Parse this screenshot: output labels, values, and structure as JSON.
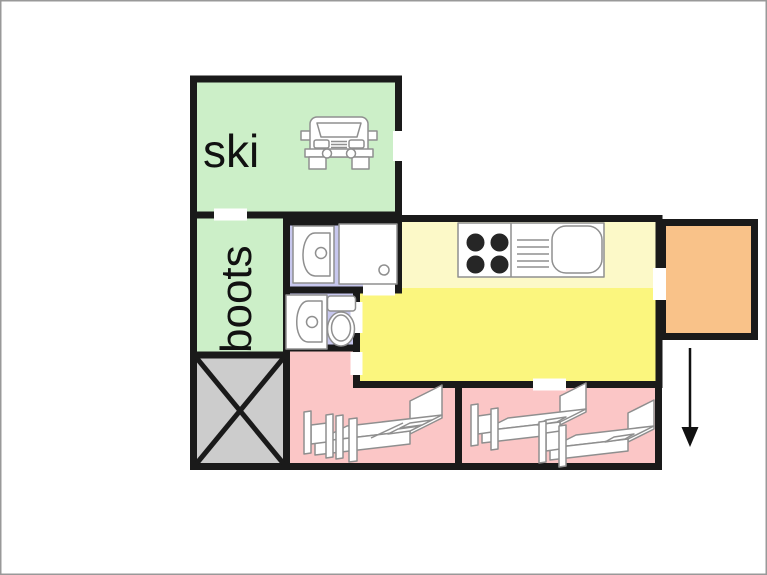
{
  "diagram": {
    "type": "chalet-floor-plan",
    "rooms": {
      "ski": {
        "label": "ski",
        "color": "#ccefc8"
      },
      "boots": {
        "label": "boots",
        "color": "#ccefc8"
      },
      "bathroom": {
        "color": "#c7c7ee",
        "fixtures": [
          "washbasin",
          "shower"
        ]
      },
      "wc": {
        "color": "#c7c7ee",
        "fixtures": [
          "washbasin",
          "toilet"
        ]
      },
      "kitchen": {
        "color": "#fcf9c8",
        "fixtures": [
          "stove",
          "drainer",
          "kitchen-sink"
        ]
      },
      "hall": {
        "color": "#fbf67e"
      },
      "porch": {
        "color": "#f9c289"
      },
      "bedroom_left": {
        "color": "#fbc6c6",
        "fixtures": [
          "double-bed"
        ]
      },
      "bedroom_right": {
        "color": "#fbc6c6",
        "fixtures": [
          "single-bed",
          "single-bed"
        ]
      },
      "stairs": {
        "color": "#cccccc",
        "fixtures": [
          "stairs-cross"
        ]
      }
    },
    "colors": {
      "wall": "#1a1a1a",
      "fixture_outline": "#8f8f8f",
      "burner": "#262626",
      "door_gap": "#ffffff",
      "frame": "#999999",
      "background": "#ffffff"
    },
    "icons": [
      "car-icon",
      "washbasin-icon",
      "shower-icon",
      "toilet-icon",
      "stove-icon",
      "drainer-icon",
      "kitchen-sink-icon",
      "double-bed-icon",
      "single-bed-icon",
      "stairs-cross-icon",
      "entrance-arrow-icon"
    ],
    "annotations": {
      "entrance_arrow_direction": "down"
    }
  }
}
